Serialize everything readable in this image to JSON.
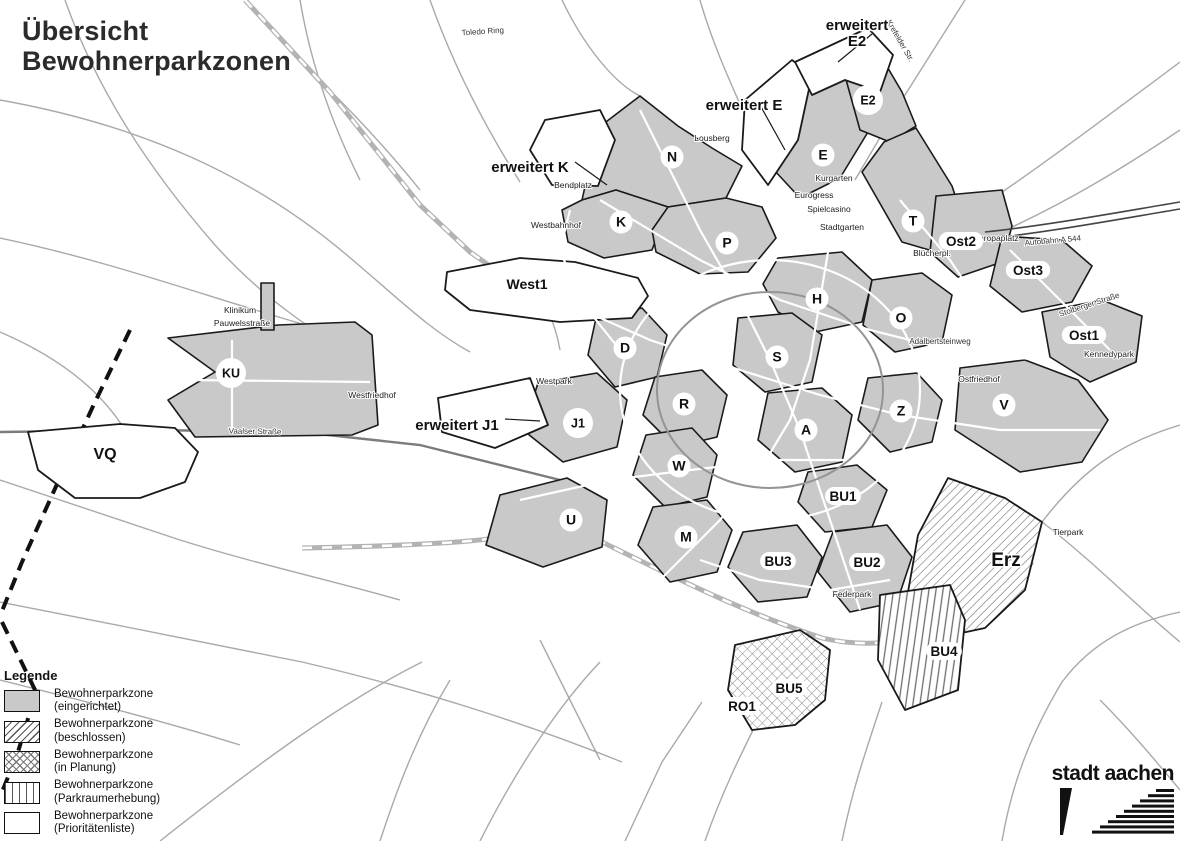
{
  "title": {
    "line1": "Übersicht",
    "line2": "Bewohnerparkzonen"
  },
  "legend": {
    "header": "Legende",
    "items": [
      {
        "pattern": "solid-gray",
        "label_line1": "Bewohnerparkzone",
        "label_line2": "(eingerichtet)"
      },
      {
        "pattern": "diagonal-hatch",
        "label_line1": "Bewohnerparkzone",
        "label_line2": "(beschlossen)"
      },
      {
        "pattern": "cross-hatch",
        "label_line1": "Bewohnerparkzone",
        "label_line2": "(in Planung)"
      },
      {
        "pattern": "vertical-lines",
        "label_line1": "Bewohnerparkzone",
        "label_line2": "(Parkraumerhebung)"
      },
      {
        "pattern": "white",
        "label_line1": "Bewohnerparkzone",
        "label_line2": "(Prioritätenliste)"
      }
    ],
    "footer": "Fachbereich Mobilität und Verkehr"
  },
  "logo": {
    "text": "stadt aachen"
  },
  "colors": {
    "zone_fill": "#c9c9c9",
    "zone_border": "#1a1a1a",
    "road": "#a6a6a6",
    "background": "#ffffff",
    "hatch_line": "#6e6e6e"
  },
  "map": {
    "zone_labels": [
      {
        "id": "N",
        "text": "N",
        "x": 672,
        "y": 157,
        "kind": "circle"
      },
      {
        "id": "K",
        "text": "K",
        "x": 621,
        "y": 222,
        "kind": "circle"
      },
      {
        "id": "P",
        "text": "P",
        "x": 727,
        "y": 243,
        "kind": "circle"
      },
      {
        "id": "E",
        "text": "E",
        "x": 823,
        "y": 155,
        "kind": "circle"
      },
      {
        "id": "E2",
        "text": "E2",
        "x": 868,
        "y": 100,
        "kind": "circle"
      },
      {
        "id": "T",
        "text": "T",
        "x": 913,
        "y": 221,
        "kind": "circle"
      },
      {
        "id": "H",
        "text": "H",
        "x": 817,
        "y": 299,
        "kind": "circle"
      },
      {
        "id": "O",
        "text": "O",
        "x": 901,
        "y": 318,
        "kind": "circle"
      },
      {
        "id": "S",
        "text": "S",
        "x": 777,
        "y": 357,
        "kind": "circle"
      },
      {
        "id": "D",
        "text": "D",
        "x": 625,
        "y": 348,
        "kind": "circle"
      },
      {
        "id": "R",
        "text": "R",
        "x": 684,
        "y": 404,
        "kind": "circle"
      },
      {
        "id": "A",
        "text": "A",
        "x": 806,
        "y": 430,
        "kind": "circle"
      },
      {
        "id": "Z",
        "text": "Z",
        "x": 901,
        "y": 411,
        "kind": "circle"
      },
      {
        "id": "V",
        "text": "V",
        "x": 1004,
        "y": 405,
        "kind": "circle"
      },
      {
        "id": "W",
        "text": "W",
        "x": 679,
        "y": 466,
        "kind": "circle"
      },
      {
        "id": "M",
        "text": "M",
        "x": 686,
        "y": 537,
        "kind": "circle"
      },
      {
        "id": "U",
        "text": "U",
        "x": 571,
        "y": 520,
        "kind": "circle"
      },
      {
        "id": "J1",
        "text": "J1",
        "x": 578,
        "y": 423,
        "kind": "circle"
      },
      {
        "id": "KU",
        "text": "KU",
        "x": 231,
        "y": 373,
        "kind": "circle"
      },
      {
        "id": "Ost2",
        "text": "Ost2",
        "x": 961,
        "y": 242,
        "kind": "pill"
      },
      {
        "id": "Ost3",
        "text": "Ost3",
        "x": 1028,
        "y": 271,
        "kind": "pill"
      },
      {
        "id": "Ost1",
        "text": "Ost1",
        "x": 1084,
        "y": 336,
        "kind": "pill"
      },
      {
        "id": "BU1",
        "text": "BU1",
        "x": 843,
        "y": 497,
        "kind": "pill"
      },
      {
        "id": "BU3",
        "text": "BU3",
        "x": 778,
        "y": 562,
        "kind": "pill"
      },
      {
        "id": "BU2",
        "text": "BU2",
        "x": 867,
        "y": 563,
        "kind": "pill"
      },
      {
        "id": "BU4",
        "text": "BU4",
        "x": 944,
        "y": 652,
        "kind": "pill"
      },
      {
        "id": "BU5",
        "text": "BU5",
        "x": 789,
        "y": 689,
        "kind": "pill"
      },
      {
        "id": "RO1",
        "text": "RO1",
        "x": 742,
        "y": 707,
        "kind": "pill"
      },
      {
        "id": "West1",
        "text": "West1",
        "x": 527,
        "y": 289,
        "kind": "plain",
        "size": 14
      },
      {
        "id": "VQ",
        "text": "VQ",
        "x": 105,
        "y": 459,
        "kind": "plain",
        "size": 16
      },
      {
        "id": "Erz",
        "text": "Erz",
        "x": 1006,
        "y": 566,
        "kind": "plain",
        "size": 19
      }
    ],
    "extension_labels": [
      {
        "id": "erweitert-K",
        "lines": [
          "erweitert K"
        ],
        "x": 530,
        "y": 160
      },
      {
        "id": "erweitert-E",
        "lines": [
          "erweitert E"
        ],
        "x": 744,
        "y": 98
      },
      {
        "id": "erweitert-E2",
        "lines": [
          "erweitert",
          "E2"
        ],
        "x": 857,
        "y": 18
      },
      {
        "id": "erweitert-J1",
        "lines": [
          "erweitert J1"
        ],
        "x": 457,
        "y": 418
      }
    ],
    "place_labels": [
      {
        "text": "Lousberg",
        "x": 712,
        "y": 141
      },
      {
        "text": "Kurgarten",
        "x": 834,
        "y": 181
      },
      {
        "text": "Eurogress",
        "x": 814,
        "y": 198
      },
      {
        "text": "Spielcasino",
        "x": 829,
        "y": 212
      },
      {
        "text": "Stadtgarten",
        "x": 842,
        "y": 230
      },
      {
        "text": "Bendplatz",
        "x": 573,
        "y": 188
      },
      {
        "text": "Westbahnhof",
        "x": 556,
        "y": 228
      },
      {
        "text": "Klinikum",
        "x": 240,
        "y": 313
      },
      {
        "text": "Pauwelsstraße",
        "x": 242,
        "y": 326
      },
      {
        "text": "Westpark",
        "x": 554,
        "y": 384
      },
      {
        "text": "Westfriedhof",
        "x": 372,
        "y": 398
      },
      {
        "text": "Ostfriedhof",
        "x": 979,
        "y": 382
      },
      {
        "text": "Kennedypark",
        "x": 1109,
        "y": 357
      },
      {
        "text": "Tierpark",
        "x": 1068,
        "y": 535
      },
      {
        "text": "Federpark",
        "x": 852,
        "y": 597
      },
      {
        "text": "Europaplatz",
        "x": 996,
        "y": 241
      },
      {
        "text": "Blücherpl.",
        "x": 932,
        "y": 256
      }
    ],
    "street_labels": [
      {
        "text": "Toledo Ring",
        "x": 483,
        "y": 34,
        "angle": -4
      },
      {
        "text": "Autobahn  A 544",
        "x": 1053,
        "y": 243,
        "angle": -5
      },
      {
        "text": "Vaalser Straße",
        "x": 255,
        "y": 434,
        "angle": 1
      },
      {
        "text": "Krefelder Str.",
        "x": 898,
        "y": 42,
        "angle": 60
      },
      {
        "text": "Stolberger Straße",
        "x": 1090,
        "y": 307,
        "angle": -18
      },
      {
        "text": "Adalbertsteinweg",
        "x": 940,
        "y": 344,
        "angle": 0
      }
    ]
  }
}
